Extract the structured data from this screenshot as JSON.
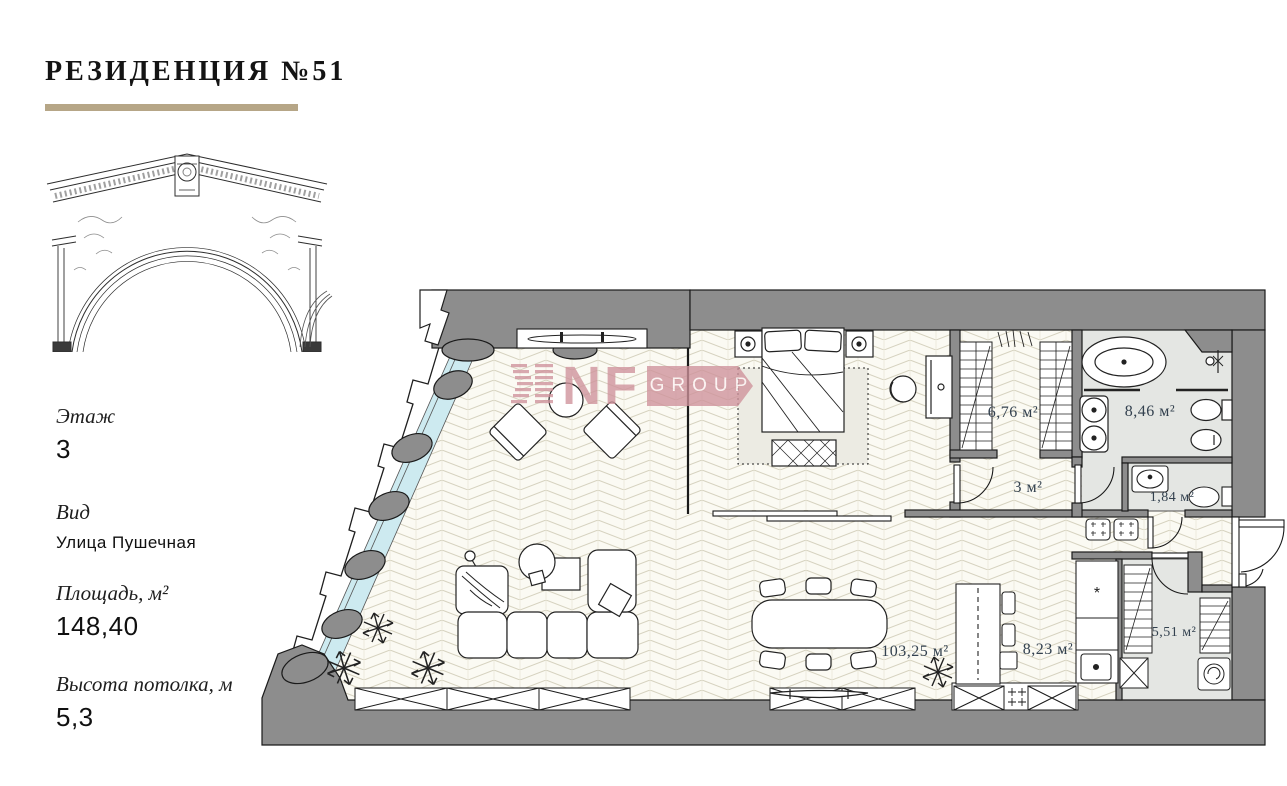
{
  "header": {
    "title": "РЕЗИДЕНЦИЯ №51"
  },
  "details": [
    {
      "label": "Этаж",
      "value": "3"
    },
    {
      "label": "Вид",
      "value": "Улица Пушечная"
    },
    {
      "label": "Площадь, м²",
      "value": "148,40"
    },
    {
      "label": "Высота потолка, м",
      "value": "5,3"
    }
  ],
  "watermark": {
    "brand": "NF",
    "suffix": "GROUP"
  },
  "plan": {
    "rooms": [
      {
        "name": "living-dining",
        "area": "103,25 м²"
      },
      {
        "name": "kitchen",
        "area": "8,23 м²"
      },
      {
        "name": "wardrobe",
        "area": "6,76 м²"
      },
      {
        "name": "hall",
        "area": "3 м²"
      },
      {
        "name": "master-bathroom",
        "area": "8,46 м²"
      },
      {
        "name": "wc",
        "area": "1,84 м²"
      },
      {
        "name": "laundry",
        "area": "5,51 м²"
      }
    ],
    "colors": {
      "wall": "#8d8d8d",
      "glazing": "#cdeaf0",
      "floor_line": "#d6d2bf",
      "accent_rule": "#b6a687",
      "watermark": "#cf929b",
      "label_text": "#33414f"
    }
  }
}
